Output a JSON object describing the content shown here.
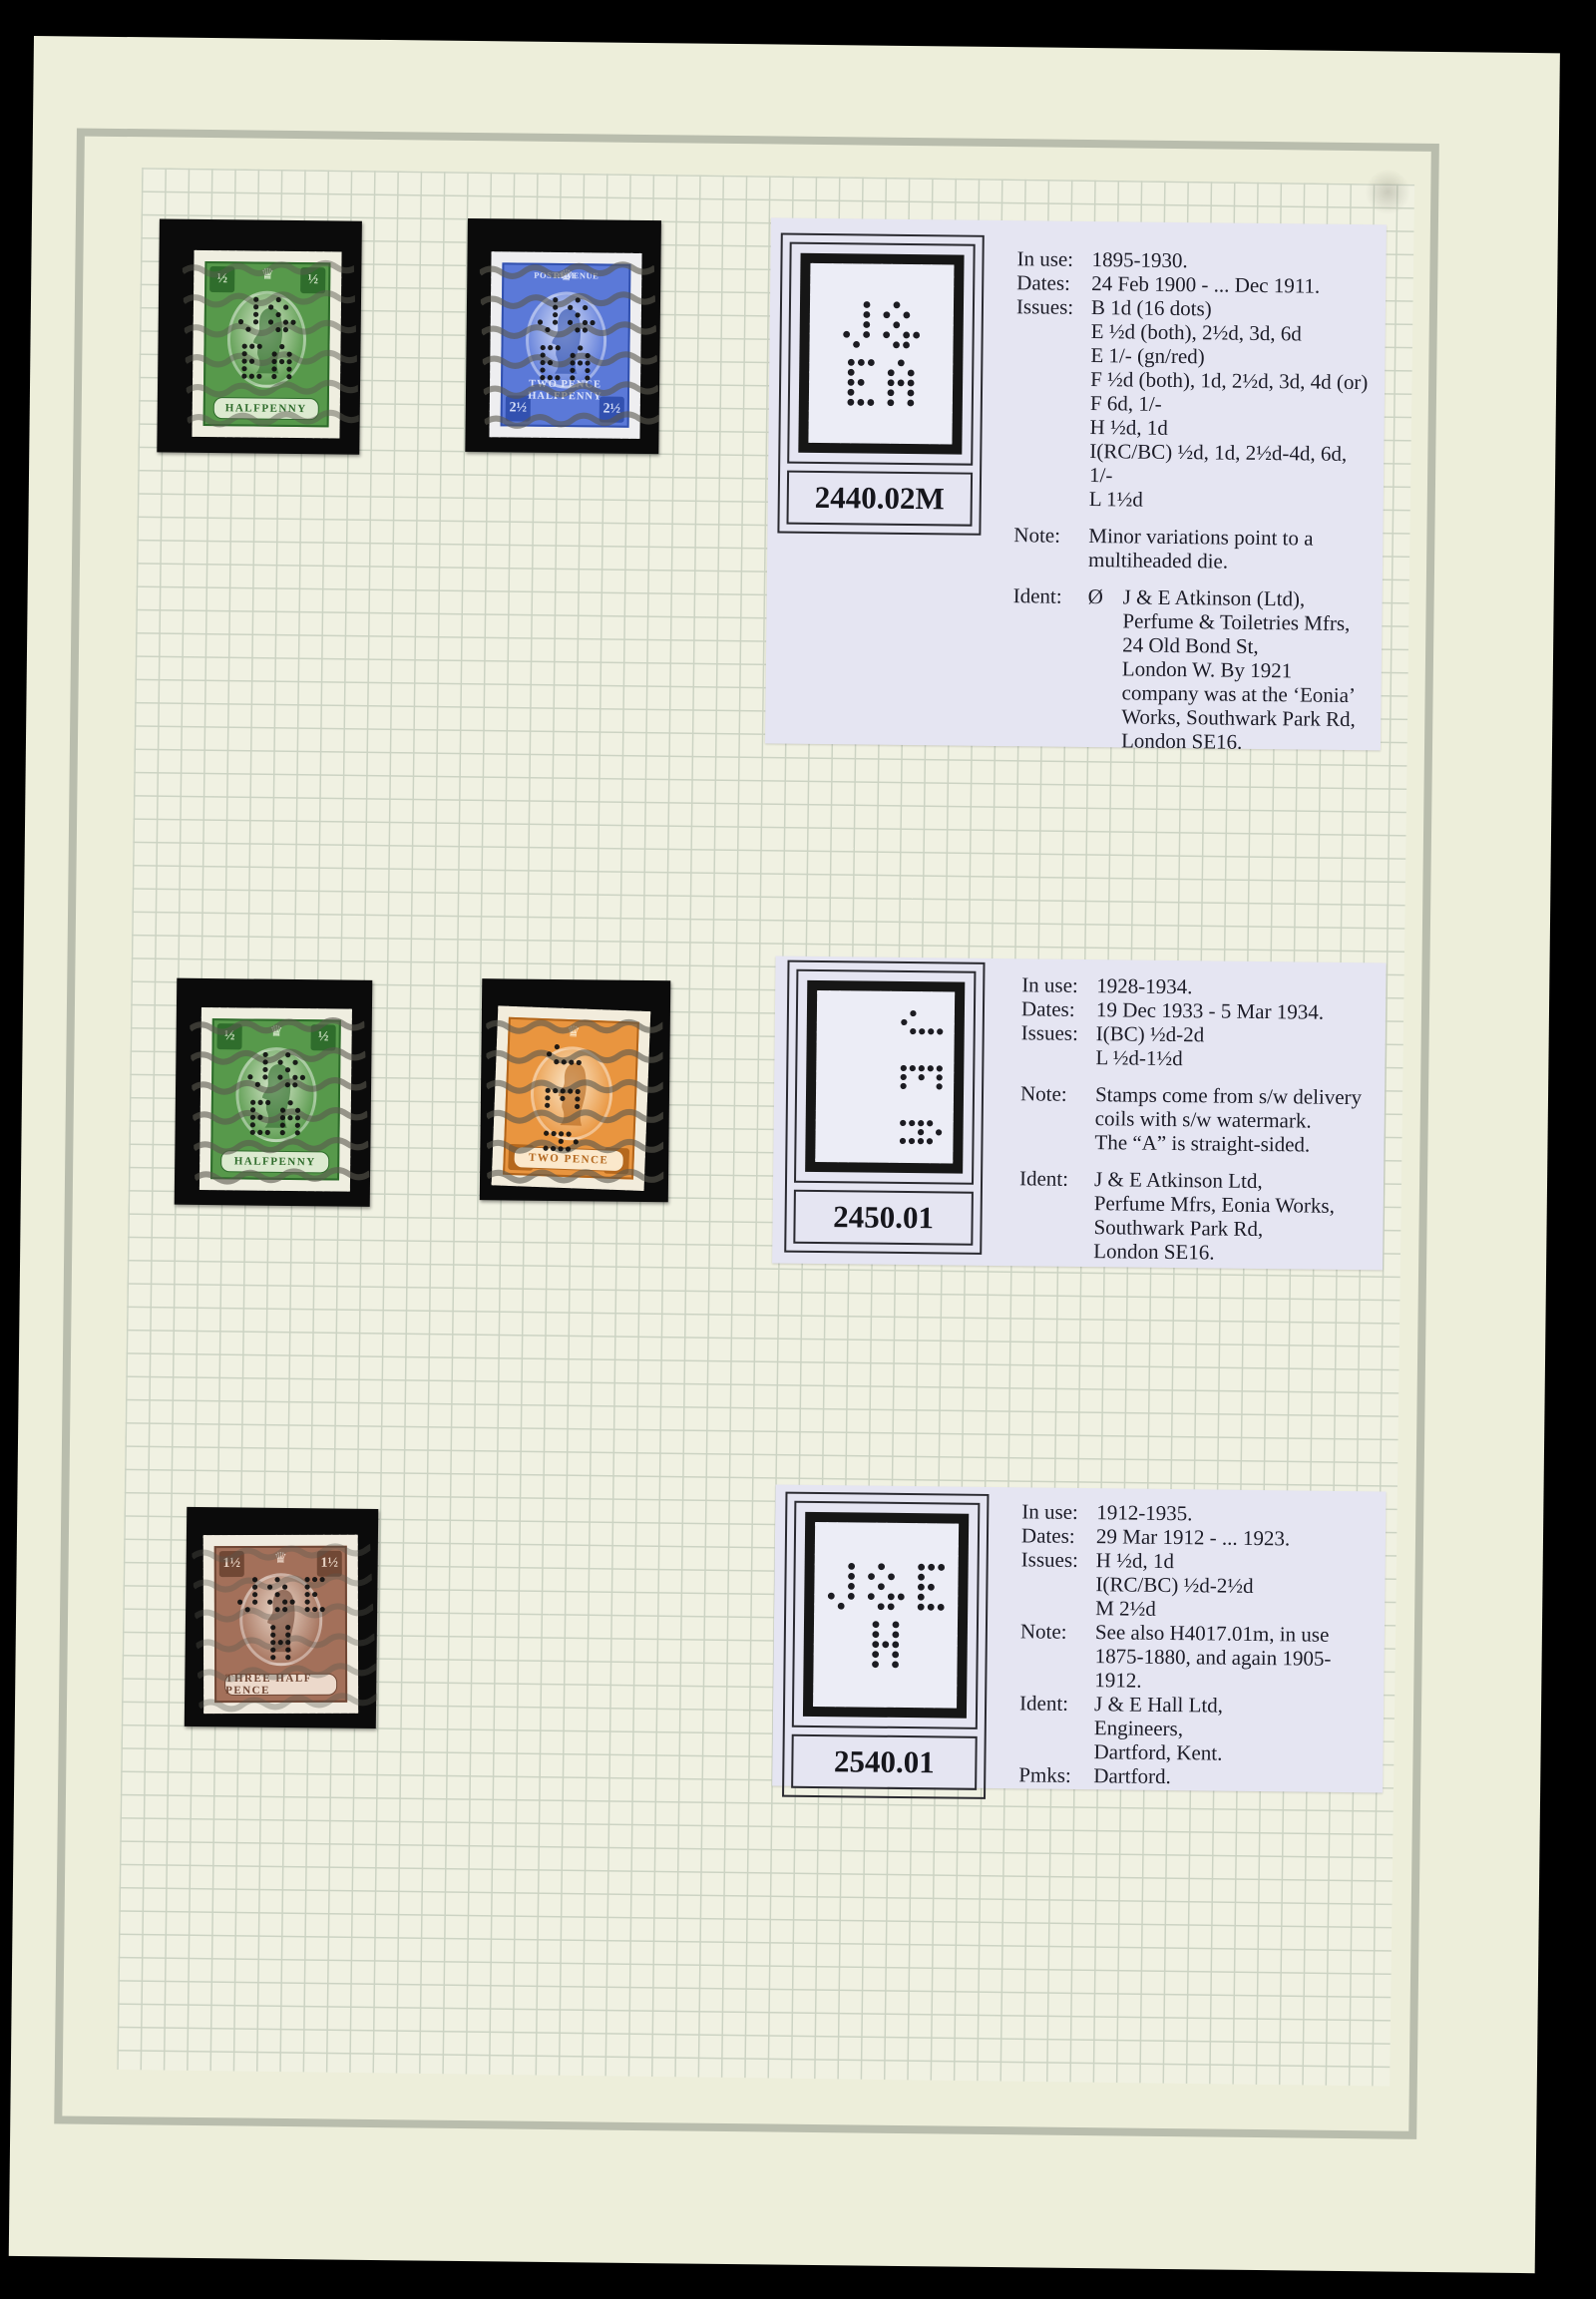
{
  "page_title": "GB KGV perfin album page",
  "colors": {
    "backdrop": "#000000",
    "page_bg": "#edeeda",
    "grid_bg": "#f0f1e2",
    "grid_line": "#ccd3c3",
    "frame_line": "#b9bdad",
    "panel_bg": "#e5e5f2",
    "mount": "#0b0b0b",
    "ink": "#1d1d28",
    "perfin_paper": "#ecedf6"
  },
  "stamps": [
    {
      "name": "halfpenny-green",
      "color": "#57994b",
      "color_dark": "#2e6b2b",
      "color_light": "#dcead0",
      "paper": "#efeee0",
      "tl": "½",
      "tr": "½",
      "bl": "",
      "br": "",
      "top_left_text": "",
      "top_right_text": "",
      "banner": [
        "HALFPENNY"
      ],
      "banner_band": true,
      "perfin": [
        "J&",
        "EA"
      ],
      "perfin_vertical": false,
      "cancel": "medium"
    },
    {
      "name": "two-pence-halfpenny-blue",
      "color": "#5b79d8",
      "color_dark": "#3150ae",
      "color_light": "#dde4fa",
      "paper": "#eeeef0",
      "tl": "",
      "tr": "",
      "bl": "2½",
      "br": "2½",
      "top_left_text": "POSTAGE",
      "top_right_text": "REVENUE",
      "banner": [
        "TWO PENCE",
        "HALFPENNY"
      ],
      "banner_band": false,
      "perfin": [
        "J&",
        "EA"
      ],
      "perfin_vertical": false,
      "cancel": "heavy"
    },
    {
      "name": "halfpenny-green",
      "color": "#57994b",
      "color_dark": "#2e6b2b",
      "color_light": "#dcead0",
      "paper": "#efeee0",
      "tl": "½",
      "tr": "½",
      "bl": "",
      "br": "",
      "top_left_text": "",
      "top_right_text": "",
      "banner": [
        "HALFPENNY"
      ],
      "banner_band": true,
      "perfin": [
        "J&",
        "EA"
      ],
      "perfin_vertical": false,
      "cancel": "heavy"
    },
    {
      "name": "two-pence-orange",
      "color": "#e9953f",
      "color_dark": "#b3661c",
      "color_light": "#fbe8cb",
      "paper": "#f2ecdc",
      "tl": "",
      "tr": "",
      "bl": "2",
      "br": "2",
      "top_left_text": "",
      "top_right_text": "",
      "banner": [
        "TWO PENCE"
      ],
      "banner_band": true,
      "perfin": [
        "J",
        "E",
        "A"
      ],
      "perfin_vertical": true,
      "cancel": "heavy"
    },
    {
      "name": "three-half-pence-brown",
      "color": "#a3705a",
      "color_dark": "#6f4634",
      "color_light": "#ecd9cb",
      "paper": "#f0ebdf",
      "tl": "1½",
      "tr": "1½",
      "bl": "",
      "br": "",
      "top_left_text": "",
      "top_right_text": "",
      "banner": [
        "THREE HALF PENCE"
      ],
      "banner_band": true,
      "perfin": [
        "J&E",
        "H"
      ],
      "perfin_vertical": false,
      "cancel": "light"
    }
  ],
  "panels": [
    {
      "number": "2440.02M",
      "perfin": [
        "J&",
        "EA"
      ],
      "perfin_vertical": false,
      "rows": [
        {
          "l": "In use:",
          "t": "1895-1930."
        },
        {
          "l": "Dates:",
          "t": "24 Feb 1900 - ... Dec 1911."
        },
        {
          "l": "Issues:",
          "t": "B 1d (16 dots)"
        },
        {
          "t": "E ½d (both), 2½d, 3d, 6d"
        },
        {
          "t": "E 1/- (gn/red)"
        },
        {
          "t": "F ½d (both), 1d, 2½d, 3d, 4d (or)"
        },
        {
          "t": "F 6d, 1/-"
        },
        {
          "t": "H ½d, 1d"
        },
        {
          "t": "I(RC/BC) ½d, 1d, 2½d-4d, 6d, 1/-"
        },
        {
          "t": "L 1½d"
        },
        {
          "l": "Note:",
          "t": "Minor variations point to a",
          "gap": true
        },
        {
          "t": "multiheaded die."
        },
        {
          "l": "Ident:",
          "sym": "Ø",
          "t": "J & E Atkinson (Ltd),",
          "gap": true
        },
        {
          "t": "Perfume & Toiletries Mfrs,",
          "ind": true
        },
        {
          "t": "24 Old Bond St,",
          "ind": true
        },
        {
          "t": "London W.  By 1921",
          "ind": true
        },
        {
          "t": "company was at the ‘Eonia’",
          "ind": true
        },
        {
          "t": "Works, Southwark Park Rd,",
          "ind": true
        },
        {
          "t": "London SE16.",
          "ind": true
        }
      ]
    },
    {
      "number": "2450.01",
      "perfin": [
        "J",
        "E",
        "A"
      ],
      "perfin_vertical": true,
      "rows": [
        {
          "l": "In use:",
          "t": "1928-1934."
        },
        {
          "l": "Dates:",
          "t": "19 Dec 1933 - 5 Mar 1934."
        },
        {
          "l": "Issues:",
          "t": "I(BC) ½d-2d"
        },
        {
          "t": "L ½d-1½d"
        },
        {
          "l": "Note:",
          "t": "Stamps come from s/w delivery",
          "gap": true
        },
        {
          "t": "coils with s/w watermark."
        },
        {
          "t": "The “A” is straight-sided."
        },
        {
          "l": "Ident:",
          "t": "J & E Atkinson Ltd,",
          "gap": true
        },
        {
          "t": "Perfume Mfrs, Eonia Works,"
        },
        {
          "t": "Southwark Park Rd,"
        },
        {
          "t": "London SE16."
        }
      ]
    },
    {
      "number": "2540.01",
      "perfin": [
        "J&E",
        "H"
      ],
      "perfin_vertical": false,
      "rows": [
        {
          "l": "In use:",
          "t": "1912-1935."
        },
        {
          "l": "Dates:",
          "t": "29 Mar 1912 - ... 1923."
        },
        {
          "l": "Issues:",
          "t": "H ½d, 1d"
        },
        {
          "t": "I(RC/BC) ½d-2½d"
        },
        {
          "t": "M 2½d"
        },
        {
          "l": "Note:",
          "t": "See also H4017.01m, in use"
        },
        {
          "t": "1875-1880, and again 1905-1912."
        },
        {
          "l": "Ident:",
          "t": "J & E Hall Ltd,"
        },
        {
          "t": "Engineers,"
        },
        {
          "t": "Dartford, Kent."
        },
        {
          "l": "Pmks:",
          "t": "Dartford."
        }
      ]
    }
  ]
}
